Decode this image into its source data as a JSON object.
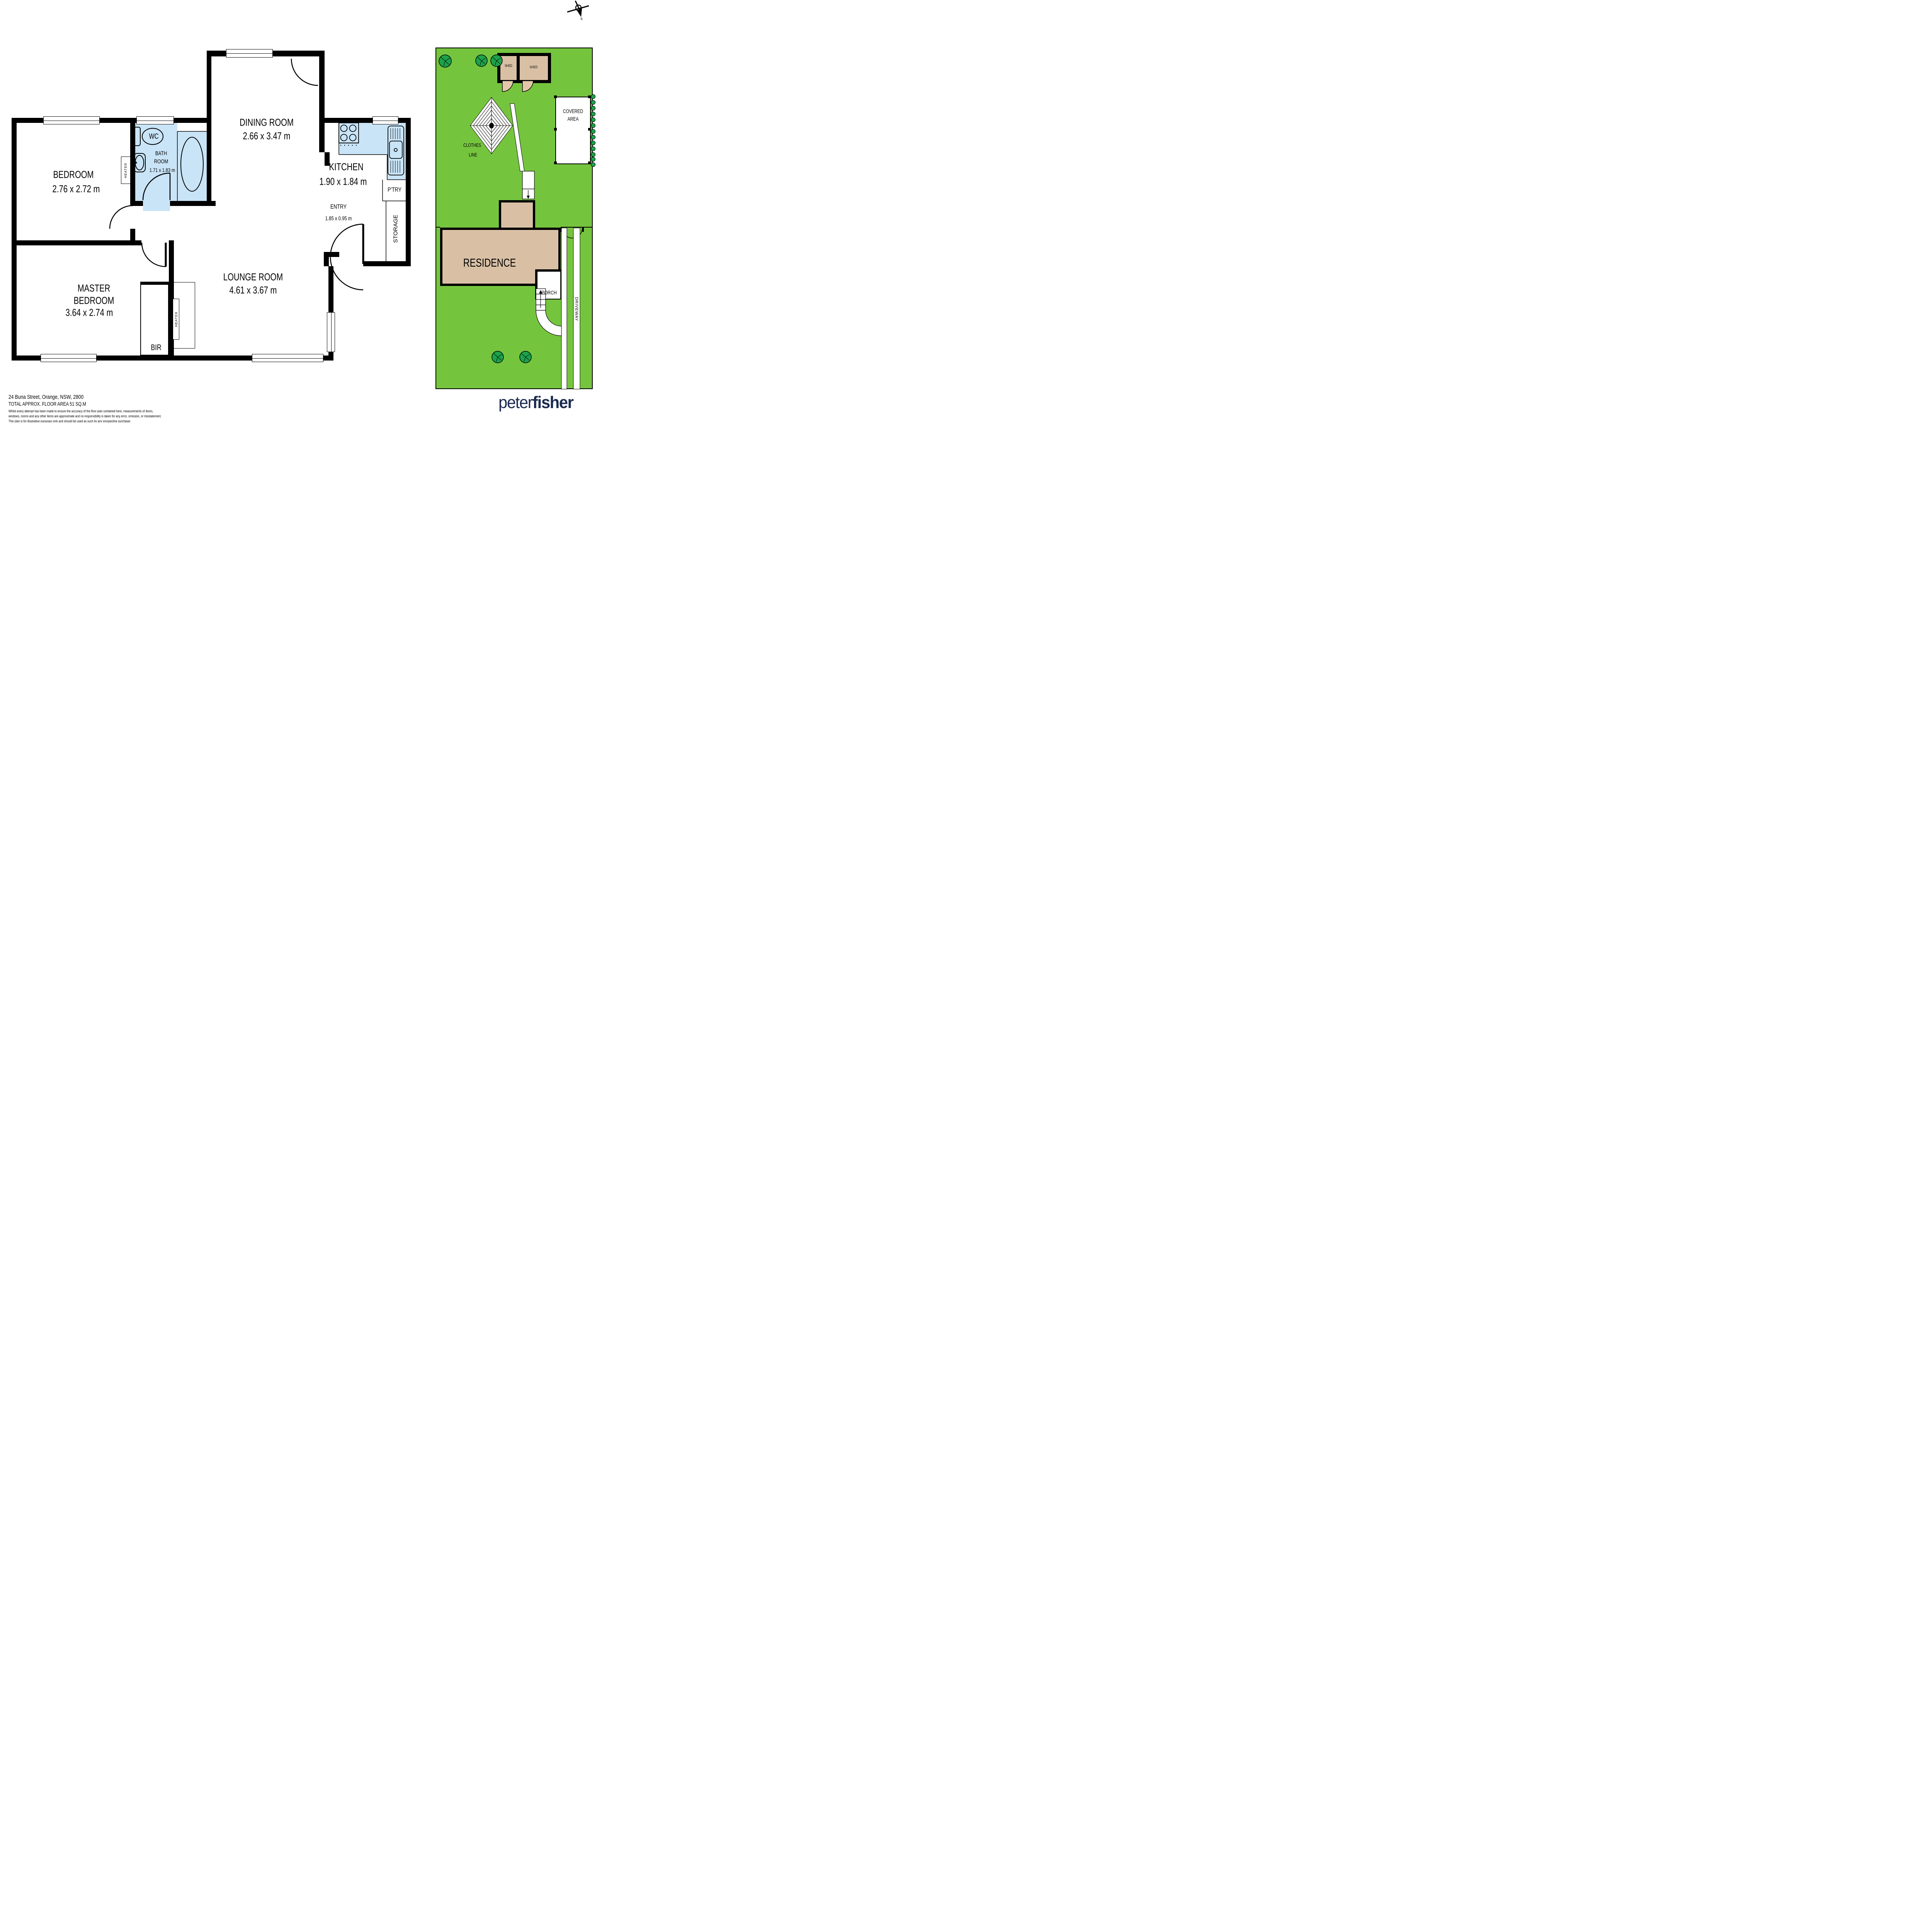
{
  "compass": {
    "north": "N"
  },
  "rooms": {
    "bedroom": {
      "name": "BEDROOM",
      "dims": "2.76 x 2.72 m"
    },
    "bathroom": {
      "line1": "BATH",
      "line2": "ROOM",
      "dims": "1.71 x 1.83 m"
    },
    "wc": {
      "name": "WC"
    },
    "dining": {
      "name": "DINING ROOM",
      "dims": "2.66 x 3.47 m"
    },
    "kitchen": {
      "name": "KITCHEN",
      "dims": "1.90 x 1.84 m"
    },
    "pantry": {
      "name": "P’TRY"
    },
    "entry": {
      "name": "ENTRY",
      "dims": "1.85 x 0.95 m"
    },
    "storage": {
      "name": "STORAGE"
    },
    "lounge": {
      "name": "LOUNGE ROOM",
      "dims": "4.61 x 3.67 m"
    },
    "master": {
      "line1": "MASTER",
      "line2": "BEDROOM",
      "dims": "3.64 x 2.74 m"
    },
    "bir": {
      "name": "BIR"
    },
    "heater": {
      "name": "HEATER"
    }
  },
  "site": {
    "shed1": "SHED",
    "shed2": "SHED",
    "covered_line1": "COVERED",
    "covered_line2": "AREA",
    "clothes_line1": "CLOTHES",
    "clothes_line2": "LINE",
    "residence": "RESIDENCE",
    "porch": "PORCH",
    "driveway": "DRIVEWAY"
  },
  "footer": {
    "address": "24 Buna Street, Orange, NSW, 2800",
    "area": "TOTAL APPROX. FLOOR AREA 51 SQ.M",
    "disclaimer1": "Whilst every attempt has been made to ensure the accuracy of the floor plan contained here, measurements of doors,",
    "disclaimer2": "windows, rooms and any other items are approximate and no responsibility is taken for any error, omission, or misstatement.",
    "disclaimer3": "This plan is for illustrative purposes only and should be used as such by any prospective purchaser."
  },
  "logo": {
    "light": "peter",
    "bold": "fisher"
  },
  "colors": {
    "fixture_blue": "#C9E4F7",
    "lawn_green": "#75C43E",
    "tree_green": "#1CA24B",
    "building_tan": "#D9C0A5",
    "logo_navy": "#1B2A50"
  }
}
